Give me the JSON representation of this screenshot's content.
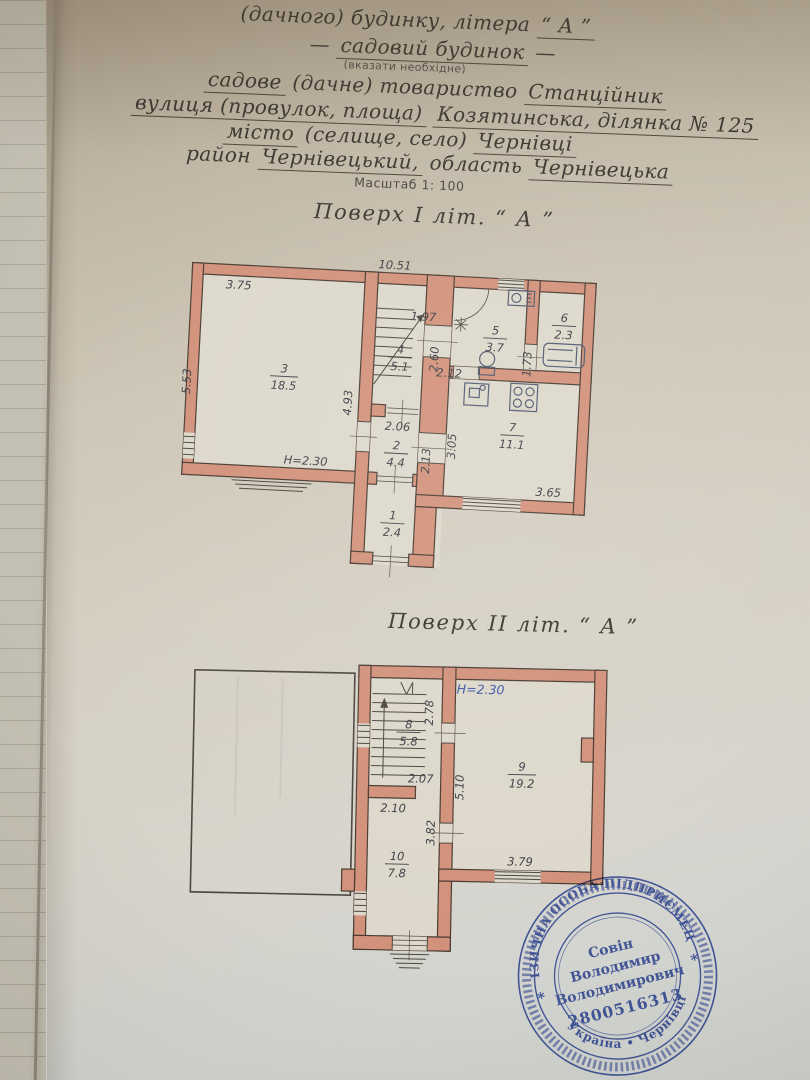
{
  "colors": {
    "paper": "#d8d2c6",
    "floorbg": "#ddd8cb",
    "wall": "#d2917a",
    "wallline": "#4a3b31",
    "ink": "#3a362f",
    "dim": "#3c3f46",
    "blue": "#3d54a6",
    "stamp": "#3b55b0",
    "thin": "#4b463e"
  },
  "header": {
    "line1_label": "(дачного) будинку, літера",
    "line1_value": "“ А ”",
    "line2_dash": "—",
    "line2_value": "садовий будинок",
    "line2_note": "(вказати необхідне)",
    "line3_value1": "садове",
    "line3_label": "(дачне) товариство",
    "line3_value2": "Станційник",
    "line4_label": "вулиця (провулок, площа)",
    "line4_value": "Козятинська, ділянка № 125",
    "line5_value1": "місто",
    "line5_label": "(селище, село)",
    "line5_value2": "Чернівці",
    "line6_label1": "район",
    "line6_value1": "Чернівецький,",
    "line6_label2": "область",
    "line6_value2": "Чернівецька",
    "scale": "Масштаб 1: 100"
  },
  "floor1": {
    "title": "Поверх  І  літ. “ А ”",
    "height_note": "H=2.30",
    "dims": {
      "top": "10.51",
      "w375": "3.75",
      "w553": "5.53",
      "w493": "4.93",
      "w197": "1.97",
      "w260": "2.60",
      "w212": "2.12",
      "w173": "1.73",
      "w206": "2.06",
      "w213": "2.13",
      "w305": "3.05",
      "w365": "3.65"
    },
    "rooms": {
      "r1": {
        "num": "1",
        "area": "2.4"
      },
      "r2": {
        "num": "2",
        "area": "4.4"
      },
      "r3": {
        "num": "3",
        "area": "18.5"
      },
      "r4": {
        "num": "4",
        "area": "5.1"
      },
      "r5": {
        "num": "5",
        "area": "3.7"
      },
      "r6": {
        "num": "6",
        "area": "2.3"
      },
      "r7": {
        "num": "7",
        "area": "11.1"
      }
    }
  },
  "floor2": {
    "title": "Поверх  ІІ  літ. “ А ”",
    "height_note": "H=2.30",
    "dims": {
      "w278": "2.78",
      "w207": "2.07",
      "w510": "5.10",
      "w210": "2.10",
      "w382": "3.82",
      "w379": "3.79"
    },
    "rooms": {
      "r8": {
        "num": "8",
        "area": "5.8"
      },
      "r9": {
        "num": "9",
        "area": "19.2"
      },
      "r10": {
        "num": "10",
        "area": "7.8"
      }
    }
  },
  "stamp": {
    "arc_top": "ФІЗИЧНА ОСОБА ПІДПРИЄМЕЦЬ",
    "arc_bottom": "Україна • Чернівці",
    "star_left": "*",
    "star_right": "*",
    "name1": "Совін",
    "name2": "Володимир",
    "name3": "Володимирович",
    "number": "2800516313"
  }
}
